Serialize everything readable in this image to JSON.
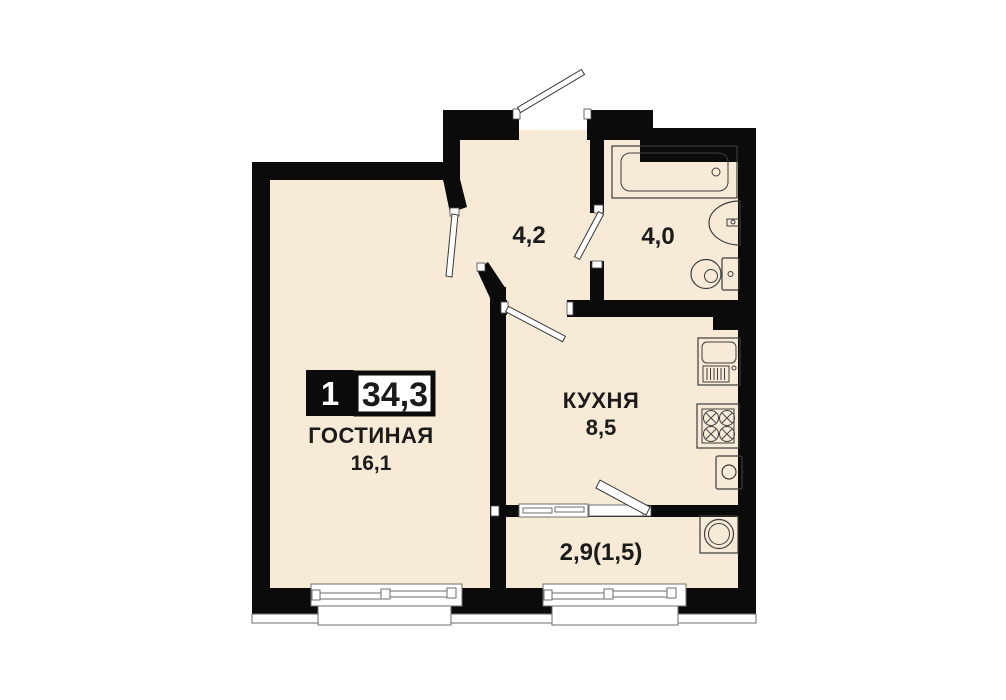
{
  "plan": {
    "type": "apartment-floor-plan",
    "badge": {
      "rooms": "1",
      "total_area": "34,3"
    },
    "rooms": [
      {
        "id": "living",
        "label": "ГОСТИНАЯ",
        "area": "16,1"
      },
      {
        "id": "kitchen",
        "label": "КУХНЯ",
        "area": "8,5"
      },
      {
        "id": "hallway",
        "label": "",
        "area": "4,2"
      },
      {
        "id": "bathroom",
        "label": "",
        "area": "4,0"
      },
      {
        "id": "balcony",
        "label": "",
        "area": "2,9(1,5)"
      }
    ],
    "fixtures": [
      "bathtub",
      "bathroom-sink",
      "toilet",
      "kitchen-sink",
      "stove",
      "water-heater",
      "washing-machine"
    ],
    "colors": {
      "floor": "#f7ead6",
      "wall": "#0b0b0b",
      "label": "#1b1b1b",
      "fixture_stroke": "#3d3d3d",
      "window_stroke": "#6e6e6e",
      "background": "#ffffff"
    }
  }
}
